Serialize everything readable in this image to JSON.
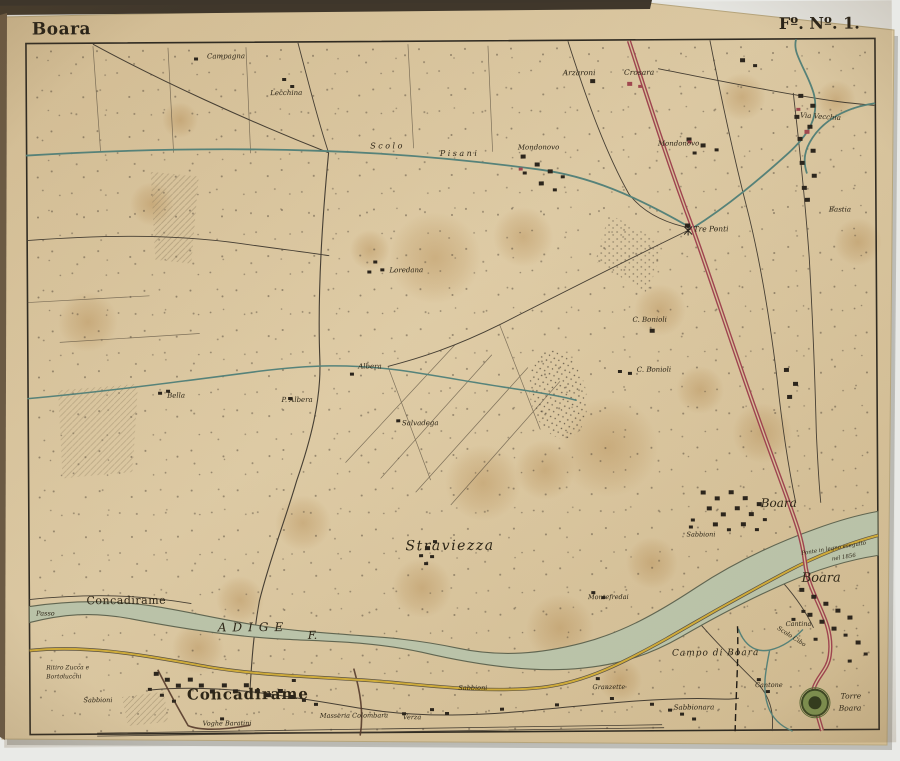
{
  "photo": {
    "backdrop": "#e9eae7"
  },
  "sheet": {
    "title": "Boara",
    "folio": "Fº. Nº. 1.",
    "paper_color": "#d9c59e"
  },
  "colors": {
    "ink": "#2b2416",
    "road_red": "#a04350",
    "canal_teal": "#55837b",
    "river_fill": "#bcc6ac",
    "road_yellow": "#d2ae3a"
  },
  "labels": {
    "title": "Boara",
    "folio": "Fº. Nº. 1.",
    "items": [
      "Campagna",
      "Lecchina",
      "Arzaroni",
      "Crosara",
      "Scolo",
      "Pisani",
      "Mondonovo",
      "Mondonovo",
      "Via Vecchia",
      "Bastia",
      "Tre Ponti",
      "Loredana",
      "C. Bonioli",
      "C. Bonioli",
      "Albera",
      "P. Albera",
      "Bella",
      "Salvadega",
      "Straviezza",
      "Boara",
      "Sabbioni",
      "Ponte in legno eseguito",
      "nel 1856",
      "Boara",
      "Montefredai",
      "Passo",
      "Concadirame",
      "ADIGE",
      "F.",
      "Ritiro Zucca e",
      "Bortolucchi",
      "Sabbioni",
      "Concadirame",
      "Voghe Baratini",
      "Masseria Colombara",
      "Verza",
      "Sabbioni",
      "Granzette",
      "Sabbionara",
      "Campo di Boara",
      "Scolo Cibo",
      "Cantone",
      "Cantina",
      "Torre",
      "Boara"
    ]
  }
}
